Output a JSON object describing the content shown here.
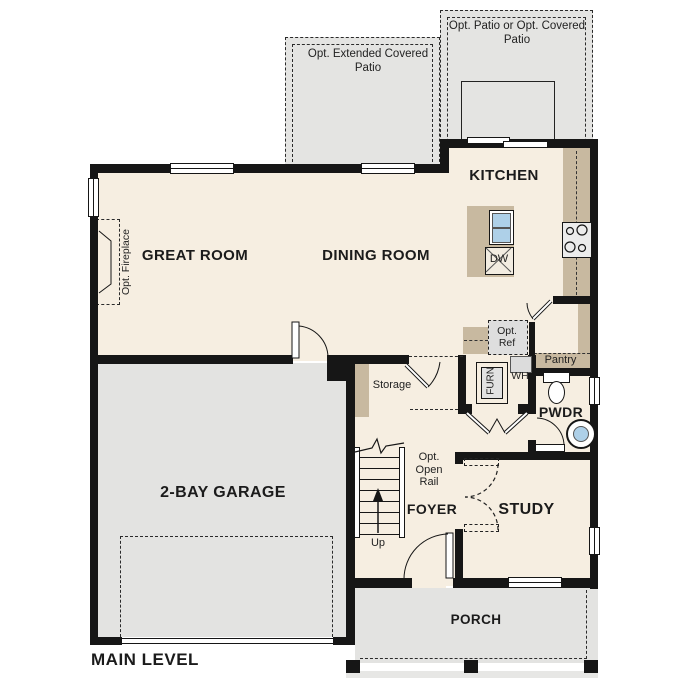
{
  "plan": {
    "title": "MAIN LEVEL",
    "rooms": {
      "great_room": "GREAT ROOM",
      "dining_room": "DINING ROOM",
      "kitchen": "KITCHEN",
      "study": "STUDY",
      "foyer": "FOYER",
      "powder": "PWDR",
      "garage": "2-BAY GARAGE",
      "porch": "PORCH"
    },
    "options": {
      "extended_patio": "Opt. Extended Covered Patio",
      "patio": "Opt. Patio or Opt. Covered Patio",
      "fireplace": "Opt. Fireplace",
      "ref": "Opt. Ref",
      "open_rail": "Opt. Open Rail"
    },
    "labels": {
      "storage": "Storage",
      "pantry": "Pantry",
      "furnace": "FURN",
      "water_heater": "WH",
      "dishwasher": "DW",
      "stairs_up": "Up"
    },
    "colors": {
      "floor": "#f6eee1",
      "counter_tan": "#c8b9a0",
      "concrete_gray": "#e4e4e2",
      "wall": "#161616",
      "fixture_blue": "#aed0e8"
    }
  }
}
